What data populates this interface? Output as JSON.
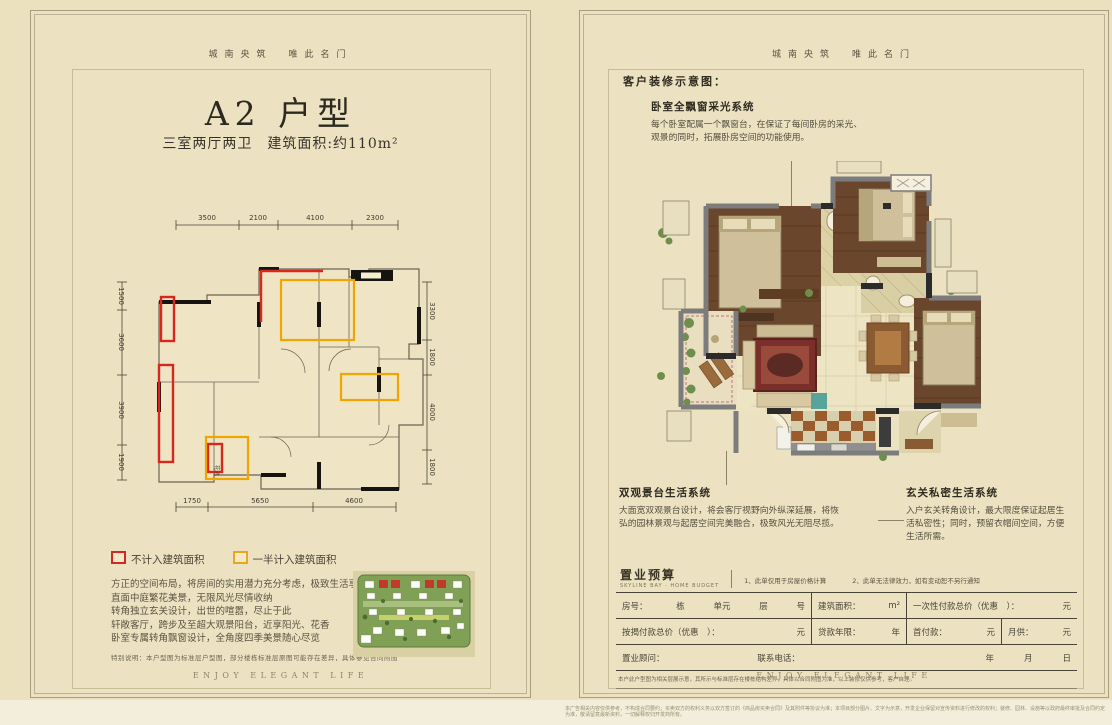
{
  "page_left": {
    "motto": "城南央筑　唯此名门",
    "title": "A2 户型",
    "subtitle": "三室两厅两卫　建筑面积:约110m²",
    "dims": {
      "top": [
        "3500",
        "2100",
        "4100",
        "2300"
      ],
      "left": [
        "1500",
        "3600",
        "3900",
        "1900"
      ],
      "right": [
        "3300",
        "1800",
        "4000",
        "1800"
      ],
      "bottom": [
        "1750",
        "5650",
        "4600"
      ]
    },
    "plan_label": "花池",
    "legend": [
      {
        "color": "#d6281e",
        "label": "不计入建筑面积"
      },
      {
        "color": "#eaa61f",
        "label": "一半计入建筑面积"
      }
    ],
    "description_lines": [
      "方正的空间布局，将房间的实用潜力充分考虑，极致生活享有",
      "直面中庭繁花美景，无限风光尽情收纳",
      "转角独立玄关设计，出世的喧嚣，尽止于此",
      "轩敞客厅，跨步及至超大观景阳台，近享阳光、花香",
      "卧室专属转角飘窗设计，全角度四季美景随心尽览"
    ],
    "note": "特别说明：本户型图为标准层户型图，部分楼栋标准层原图可能存在差异，具体参见合同附图",
    "footer": "ENJOY ELEGANT LIFE"
  },
  "page_right": {
    "motto": "城南央筑　唯此名门",
    "heading": "客户装修示意图：",
    "annotations": [
      {
        "title": "卧室全飘窗采光系统",
        "body": "每个卧室配属一个飘窗台，在保证了每间卧房的采光、观景的同时，拓展卧房空间的功能使用。"
      },
      {
        "title": "双观景台生活系统",
        "body": "大面宽双观景台设计，将会客厅视野向外纵深延展，将恢弘的园林景观与起居空间完美融合，极致风光无阻尽揽。"
      },
      {
        "title": "玄关私密生活系统",
        "body": "入户玄关转角设计，最大限度保证起居生活私密性；同时，预留衣帽间空间，方便生活所需。"
      }
    ],
    "budget": {
      "title": "置业预算",
      "subtitle": "SKYLINE BAY · HOME BUDGET",
      "notes": [
        "1、此单仅用于房屋价格计算",
        "2、此单无法律效力，如有变动恕不另行通知"
      ],
      "r1c1_label": "房号：",
      "r1c1_units": [
        "栋",
        "单元",
        "层",
        "号"
      ],
      "r1c2_label": "建筑面积：",
      "r1c2_unit": "m²",
      "r1c3_label": "一次性付款总价（优惠　）：",
      "r1c3_unit": "元",
      "r2c1_label": "按揭付款总价（优惠　）：",
      "r2c1_unit": "元",
      "r2c2_label": "贷款年限：",
      "r2c2_unit": "年",
      "r2c3_label": "首付款：",
      "r2c3_unit": "元",
      "r2c4_label": "月供：",
      "r2c4_unit": "元",
      "r3c1_label": "置业顾问：",
      "r3c2_label": "联系电话：",
      "r3_date": [
        "年",
        "月",
        "日"
      ],
      "footnote": "本户此户型图为相关层展示意，其所示与标准层存在楼栋结构差异，具体以合同附图为准，以上装修仅供参考，客户自理。"
    },
    "footer": "ENJOY ELEGANT LIFE"
  },
  "bottom_strip": {
    "text": "本广告相关内容仅供参考，不构成合同要约；买卖双方的权利义务以双方签订的《商品房买卖合同》及其附件等协议为准；本项目部分图片、文字为示意，开发企业保留对宣传资料进行修改的权利；装修、园林、设施等以政府最终审批及合同约定为准，敬请留意最新资料，一切解释权归开发商所有。"
  }
}
